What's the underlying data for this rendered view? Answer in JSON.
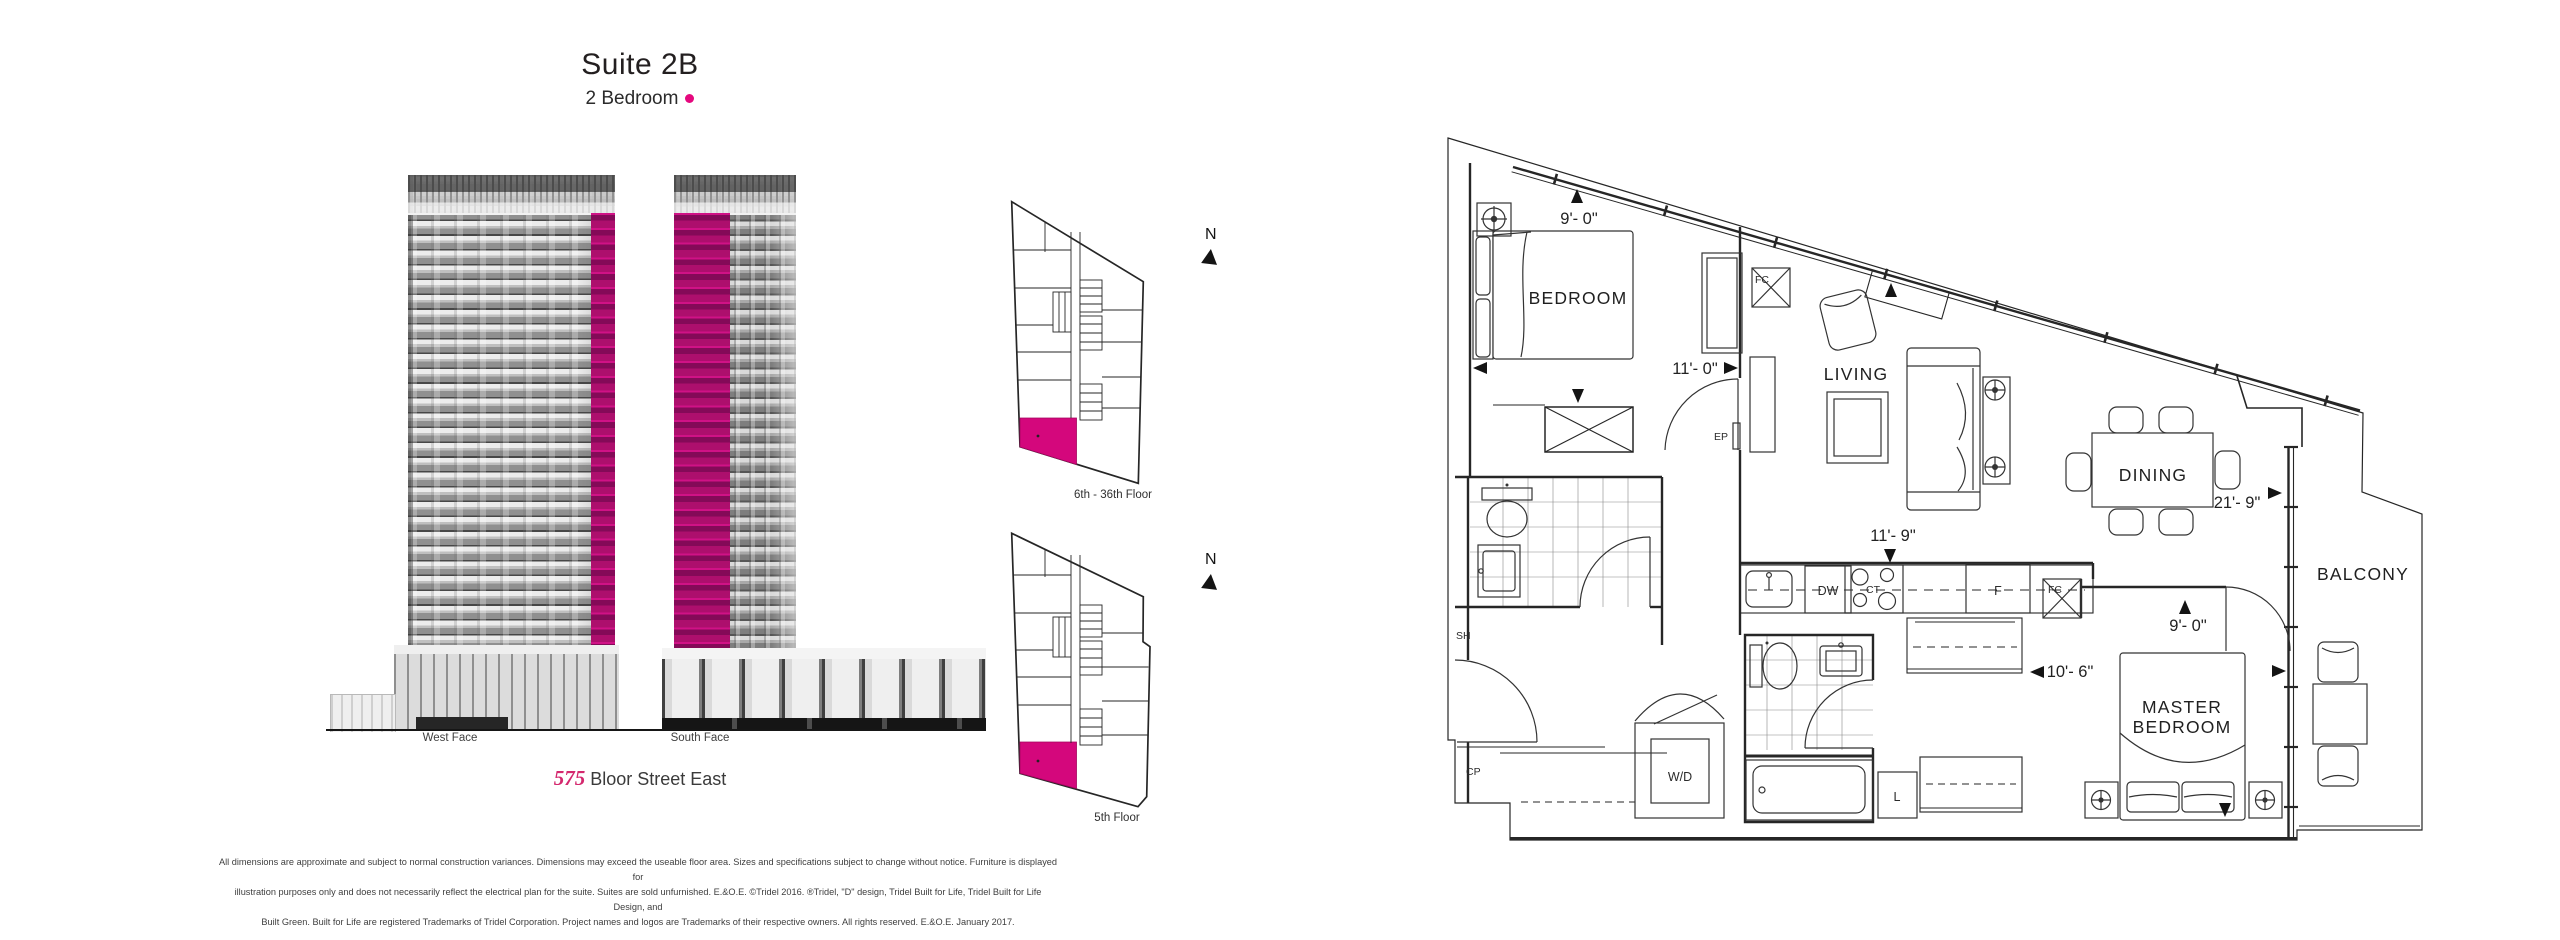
{
  "title": {
    "suite": "Suite 2B",
    "type": "2 Bedroom"
  },
  "elevation": {
    "west_label": "West Face",
    "south_label": "South Face",
    "address_num": "575",
    "address_street": "Bloor Street East"
  },
  "keyplans": {
    "upper_label": "6th - 36th Floor",
    "lower_label": "5th Floor",
    "north": "N"
  },
  "floorplan": {
    "rooms": {
      "bedroom": "BEDROOM",
      "living": "LIVING",
      "dining": "DINING",
      "balcony": "BALCONY",
      "master_line1": "MASTER",
      "master_line2": "BEDROOM",
      "wd": "W/D"
    },
    "fixtures": {
      "fc": "FC",
      "ep": "EP",
      "sh": "SH",
      "cp": "CP",
      "dw": "DW",
      "ct": "CT",
      "fridge": "F",
      "linen": "L"
    },
    "dimensions": {
      "bedroom_window": "9'- 0\"",
      "bedroom_depth": "11'- 0\"",
      "living_width": "11'- 9\"",
      "living_dining_span": "21'- 9\"",
      "master_window": "9'- 0\"",
      "master_span": "10'- 6\""
    }
  },
  "disclaimer": {
    "line1": "All dimensions are approximate and subject to normal construction variances. Dimensions may exceed the useable floor area. Sizes and specifications subject to change without notice. Furniture is displayed for",
    "line2": "illustration purposes only and does not necessarily reflect the electrical plan for the suite. Suites are sold unfurnished. E.&O.E. ©Tridel 2016. ®Tridel, \"D\" design, Tridel Built for Life, Tridel Built for Life Design, and",
    "line3": "Built Green. Built for Life are registered Trademarks of Tridel Corporation. Project names and logos are Trademarks of their respective owners. All rights reserved. E.&O.E. January 2017."
  },
  "colors": {
    "magenta": "#e5087e",
    "suite_fill": "#d4077c"
  }
}
